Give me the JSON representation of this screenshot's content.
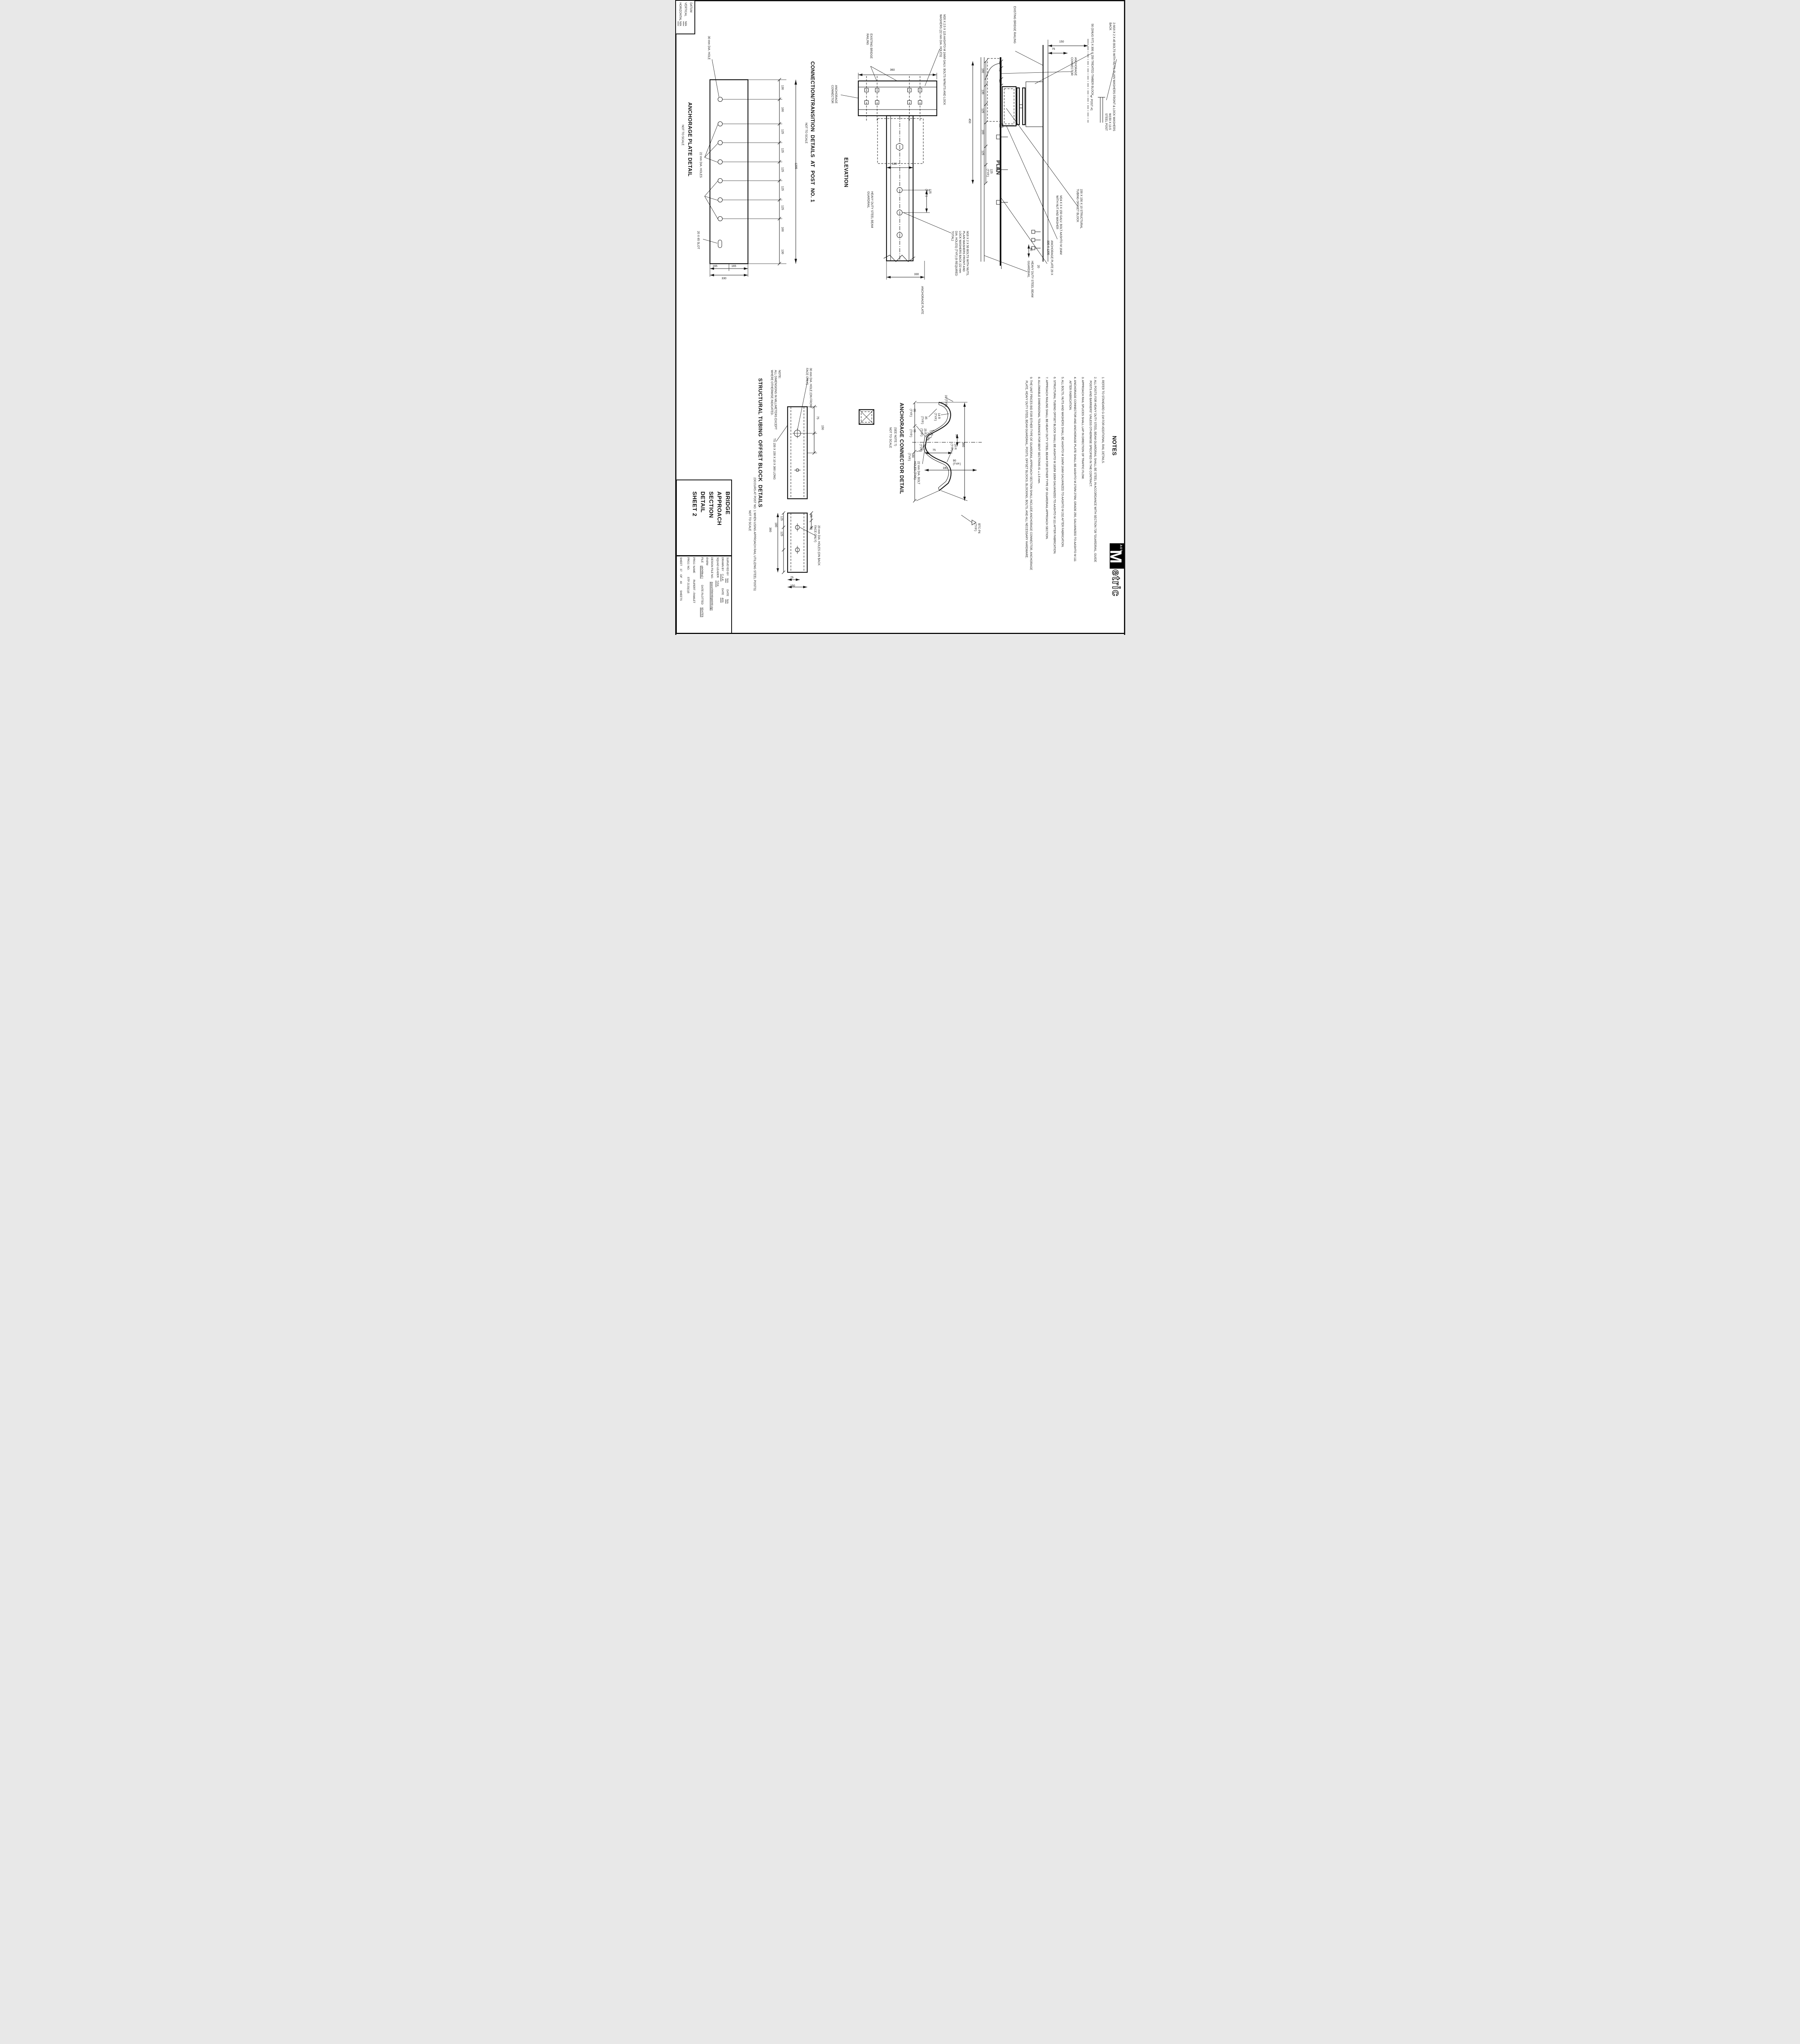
{
  "datum": {
    "title": "DATUM",
    "vertical_label": "VERTICAL",
    "vertical_value": "N/A",
    "horizontal_label": "HORIZONTAL",
    "horizontal_value": "N/A"
  },
  "plate_detail": {
    "title": "ANCHORAGE PLATE DETAIL",
    "scale_note": "NOT TO SCALE",
    "hole_top_label": "30 mm DIA. HOLE",
    "holes_label": "22 mm DIA. HOLES",
    "slot_label": "20 X 65 SLOT",
    "chain": [
      "130",
      "160",
      "125",
      "125",
      "125",
      "125",
      "125",
      "160",
      "130"
    ],
    "total": "1205",
    "dim_165_left": "165",
    "dim_165_right": "165",
    "dim_330": "330"
  },
  "connection": {
    "title": "CONNECTION/TRANSITION  DETAILS  AT  POST  NO. 1",
    "scale_note": "NOT TO SCALE",
    "elevation": {
      "title": "ELEVATION",
      "existing_railing": "EXISTING BRIDGE RAILING",
      "anchorage_connector": "ANCHORAGE CONNECTOR",
      "m20_note": "M20 X 2.5 X 115 AASHTO M 164M GALV. BOLTS W/NUTS AND LOCK WASHERS (22 mm DIA. HOLES)",
      "dim_360": "360",
      "dim_180": "180",
      "guardrail_label": "HEAVY DUTY STEEL BEAM GUARDRAIL",
      "dim_125_typ": "125 (TYP.)",
      "m16_note": "M16 X 2 X 50 BOLTS WITH NUTS, PLAIN WASHERS FRONT AND LOCK WASHERS BACK (22 mm DIA. HOLES) (TYP.) (6 REQUIRED TOTAL)",
      "dim_330": "330",
      "anchorage_plate_label": "ANCHORAGE PLATE"
    },
    "plan": {
      "title": "PLAN",
      "existing_railing": "EXISTING BRIDGE RAILING",
      "anchorage_connector": "ANCHORAGE CONNECTOR",
      "bolts_note": "2-M16 X 2 X 45 BOLTS WITH NUTS, PLAIN WASHERS FRONT & LOCK WASHERS BACK",
      "timber_note": "50 (SNUG FIT) X 300 X 250 TREATED TIMBER BLOCK",
      "dim_150": "150",
      "dim_75": "75",
      "dim_40a": "40",
      "dim_75b": "75",
      "dim_40b": "40",
      "dim_450": "450",
      "dim_160a": "160",
      "dim_130": "130",
      "dim_125a": "125",
      "dim_160b": "160",
      "dim_125b": "125",
      "dim_125_typ": "125 (TYP.)",
      "cl_post": "℄ POST #1",
      "steel_post": "W150 X 13.5 STEEL POST",
      "tubing_label": "150 X 150 X 10 STRUCTURAL TUBING OFFSET BLOCK",
      "m24_note": "M24 X 3 X 150  GALV. BOLT AASHTO M 164M WITH NUT AND WASHER",
      "anchorage_plate_label": "ANCHORAGE PLATE 20 X 330 X 1205",
      "guardrail_label": "HEAVY DUTY STEEL BEAM GUARDRAIL",
      "dim_80": "80",
      "dim_20": "20"
    }
  },
  "mm_note": "NOTE:\nALL DIMENSIONS IN MILLIMETERS EXCEPT\nWHERE OTHERWISE INDICATED.",
  "tubing_detail": {
    "title": "STRUCTURAL TUBING  OFFSET BLOCK  DETAILS",
    "occurs_note": "(OCCURS AT POST NO. 1 WHEN USING APPROACH RAIL UTILIZING STEEL POSTS)",
    "scale_note": "NOT TO SCALE",
    "hole_front_label": "30 mm DIA. HOLE (ON FRONT FACE ONLY)",
    "ts_label": "TS 150 X 150 X 10 X 360 LONG",
    "holes_back_label": "20 mm DIA. HOLES (ON BACK FACE ONLY)",
    "dim_75a": "75",
    "dim_150a": "150",
    "dim_125a": "125",
    "dim_125b": "125",
    "dim_180": "180",
    "dim_360": "360",
    "dim_28a": "28",
    "dim_28b": "28",
    "dim_75b": "75",
    "dim_150b": "150"
  },
  "connector_detail": {
    "title": "ANCHORAGE CONNECTOR DETAIL",
    "see_note": "(SEE NOTE 7)",
    "scale_note": "NOT TO SCALE",
    "dim_10": "10 (TYP.)",
    "dim_35": "35 (TYP.)",
    "dim_85": "85 (TYP.)",
    "dim_14r_top": "14 R (TYP.)",
    "dim_25r": "25 R (TYP.)",
    "dim_95": "95 (TYP.)",
    "dim_25": "25 (TYP.)",
    "dim_30": "30",
    "dim_50": "50 (TYP.)",
    "dim_75": "75",
    "dim_180_typ": "180 (TYP.)",
    "dim_14r_bot": "14 R (TYP.)",
    "dim_360": "360",
    "dim_90": "90 (TYP.)",
    "dim_180": "180",
    "holes_label": "22 mm DIA. BOLT HOLES (TYP.)",
    "btc_label": "BTC-P4 (TYP.)"
  },
  "notes": {
    "title": "NOTES",
    "items": [
      "1. REFER TO STANDARD G-1M FOR ADDITIONAL RAIL DETAILS.",
      "2. ALL POSTS FOR HEAVY DUTY STEEL BEAM GUARDRAIL SHALL BE STEEL IN ACCORDANCE WITH SECTION 728 \"GUARDRAIL, GUIDE POSTS AND BARRIERS\" UNLESS OTHERWISE SPECIFIED IN THE CONTRACT.",
      "3. APPROACH RAIL SPLICES SHALL  LAP IN DIRECTION OF TRAFFIC FLOW.",
      "4. ANCHORAGE CONNECTOR AND ANCHORAGE PLATE SHALL BE AASHTO M 270/M 270M, GRADE 250, GALVANIZED TO AASHTO M 111 AFTER FABRICATION.",
      "5. ALL BOLTS, NUTS AND WASHERS SHALL BE AASHTO M 164/M 164M GALVANIZED TO AASHTO M 232 AFTER FABRICATION.",
      "6. STRUCTURAL TUBING OFFSET BLOCK SHALL BE AASHTO M 183/M 183M GALVANIZED TO AASHTO M 111 AFTER FABRICATION.",
      "7. APPROACH RAILING SHALL BE HEAVY DUTY STEEL BEAM FOR EITHER TYPE OF GUARDRAIL APPROACH SECTION.",
      "8. ALLOWABLE DIMENSIONAL TOLERANCE FOR BENT SECTIONS IS ±1.6 mm.",
      "9. THE UNIT PRICES BID FOR EITHER TYPE OF GUARDRAIL APPROACH SECTION SHALL INCLUDE ANCHORAGE CONNECTOR, ANCHORAGE PLATE, HEAVY DUTY STEEL BEAM GUARDRAIL, POSTS, OFFSET BLOCKS, BLOCKING, BOLTS, AND ALL NECESSARY HARDWARE."
    ]
  },
  "title_block": {
    "title": "BRIDGE\nAPPROACH\nSECTION\nDETAIL\nSHEET 2",
    "surveyed_label": "SURVEYED BY",
    "surveyed_value": "N/A",
    "surveyed_date_label": "DATE",
    "surveyed_date": "N/A",
    "drawn_label": "DRAWN BY",
    "drawn_value": "C.A.K.",
    "drawn_date_label": "DATE",
    "drawn_date": "4/01",
    "squad_label": "SQUAD LEADER",
    "squad_value": "T.P.K.",
    "design_file_label": "DESIGN FILE NO.",
    "design_file_value": "/pave/00b048/pb048.dgn",
    "iparm_label": "IPARM",
    "file_label": "FILE",
    "file_value": "pb048ba2.i",
    "plotted_label": "DATE PLOTTED",
    "plotted_value": "$DATE$",
    "proj_name_label": "PROJ. NAME",
    "proj_name_value": "RUPERT - PAWLET",
    "proj_no_label": "PROJ. NO.",
    "proj_no_value": "STP 2133(1)S",
    "sheet_label": "SHEET",
    "sheet_no": "37",
    "of_label": "OF",
    "sheet_total": "40",
    "sheets_label": "SHEETS"
  },
  "logo": {
    "agency": "AOT",
    "m": "M",
    "rest": "etric"
  }
}
